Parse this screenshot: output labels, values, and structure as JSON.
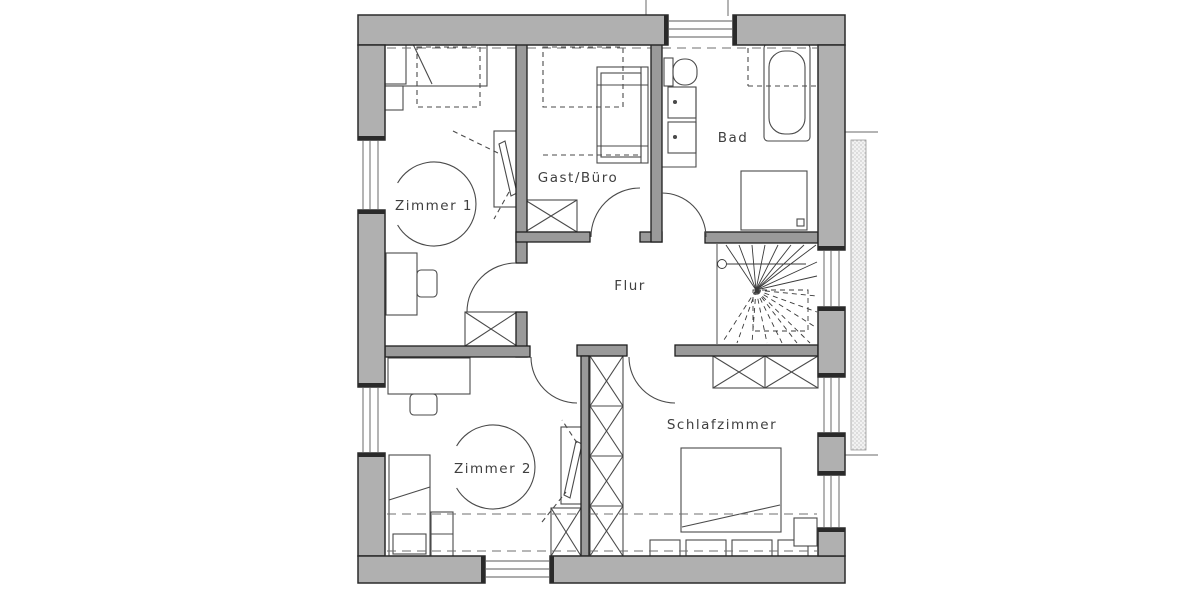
{
  "plan": {
    "type": "floor-plan-upper-floor",
    "rooms": {
      "zimmer1": {
        "label": "Zimmer 1"
      },
      "gast_buero": {
        "label": "Gast/Büro"
      },
      "bad": {
        "label": "Bad"
      },
      "flur": {
        "label": "Flur"
      },
      "zimmer2": {
        "label": "Zimmer 2"
      },
      "schlafzimmer": {
        "label": "Schlafzimmer"
      }
    },
    "features": [
      "winder-staircase",
      "bathtub",
      "double-washbasin",
      "wc",
      "shower",
      "beds",
      "desks",
      "x-hatched-wardrobes",
      "roof-slope-dashed-lines",
      "windows"
    ],
    "colors": {
      "outer_wall": "#b0b0b0",
      "interior_wall": "#9a9a9a",
      "wall_line": "#2a2a2a",
      "furniture_line": "#4a4a4a",
      "text": "#3f3f3f",
      "background": "#ffffff"
    }
  }
}
